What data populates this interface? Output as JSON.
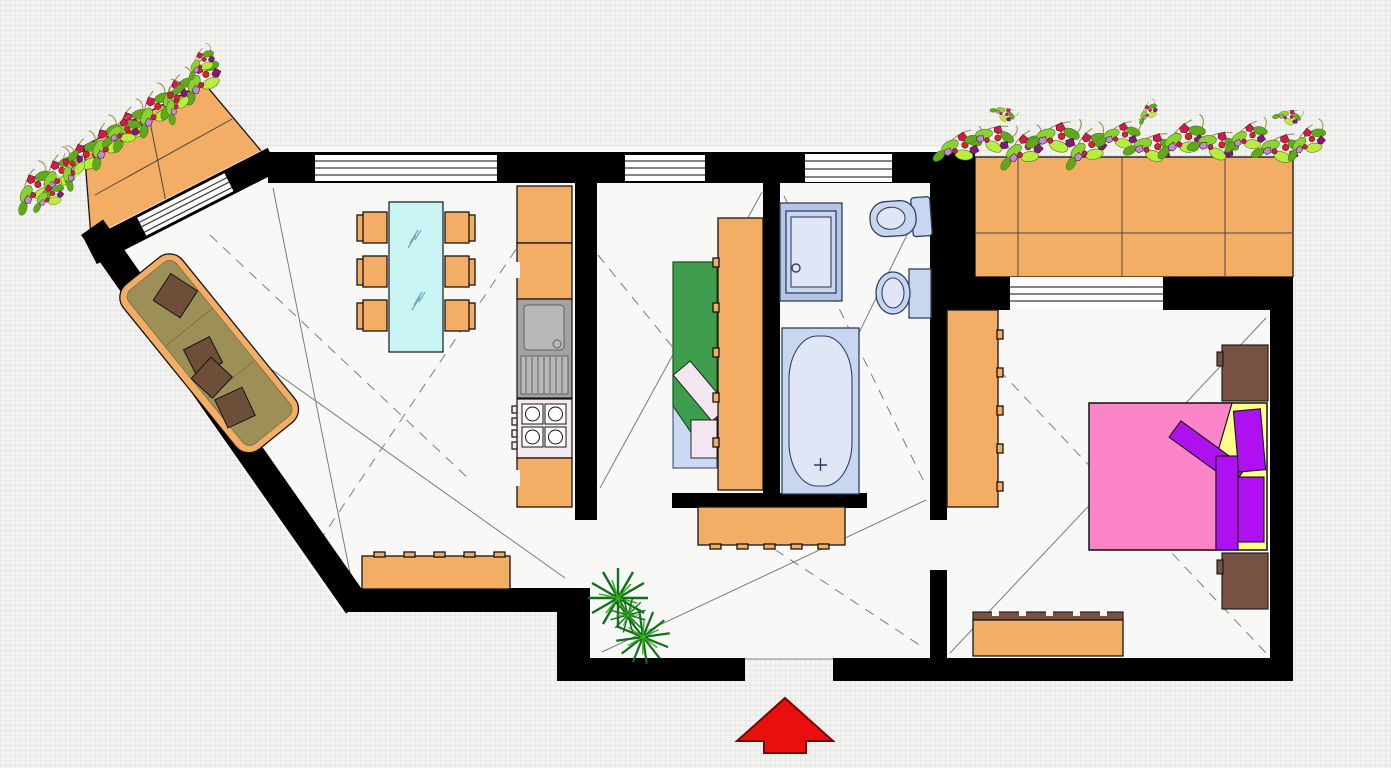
{
  "palette": {
    "wall": "#000000",
    "floor": "#f8f8f7",
    "grid_bg": "#f3f3f1",
    "grid_line": "#dedede",
    "window": "#ffffff",
    "window_line": "#3a3a3a",
    "tile": "#f4ad64",
    "tile_line": "#4a4a44",
    "outline": "#141414",
    "sofa_seat": "#9c8f57",
    "sofa_seam": "#837748",
    "sofa_pillow": "#6d4e38",
    "glass": "#c8f4f4",
    "glass_line": "#6fa3b5",
    "steel": "#a2a2a2",
    "steel_light": "#b8b8b8",
    "drain_line": "#606060",
    "stove": "#f6eaf1",
    "burner": "#ffffff",
    "fixture": "#c9d6f0",
    "fixture_light": "#dfe7f7",
    "fixture_line": "#2e3f63",
    "shower_frame": "#b7c5e4",
    "green_bed": "#3f9e4d",
    "green_dark": "#14541f",
    "sheet": "#ccd9f2",
    "pillow_pale": "#f4e6f0",
    "bed_pink": "#fb85c8",
    "bed_yellow": "#ffff8e",
    "bed_purple": "#af10f0",
    "wood_dark": "#775141",
    "arrow": "#ea0f0f",
    "arrow_outline": "#7c0000",
    "leaf1": "#8bd231",
    "leaf2": "#61a81c",
    "leaf3": "#b9ee3e",
    "leaf_line": "#3f7d12",
    "bloom1": "#d21a4a",
    "bloom2": "#7c1b7c",
    "bloom3": "#b78fdc",
    "bloom4": "#dd2222",
    "bloom_line": "#5c0e2e",
    "stem": "#a49146",
    "plant_dark": "#11701b",
    "plant_light": "#3cb31e",
    "line_thin": "#7c7c7c",
    "threshold": "#a8a8a8"
  },
  "plan": {
    "rooms": [
      {
        "name": "living-room-with-kitchen",
        "features": [
          "sofa",
          "dining-table",
          "chairs-6",
          "kitchen-cabinets",
          "kitchen-sink",
          "stove",
          "sideboard",
          "window",
          "balcony-door"
        ]
      },
      {
        "name": "middle-room",
        "features": [
          "single-bed",
          "wardrobe",
          "window"
        ]
      },
      {
        "name": "bathroom",
        "features": [
          "shower-cabin",
          "toilet",
          "washbasin",
          "bathtub",
          "window"
        ]
      },
      {
        "name": "bedroom",
        "features": [
          "double-bed",
          "wardrobe",
          "nightstand-top",
          "nightstand-bottom",
          "dresser",
          "window"
        ]
      },
      {
        "name": "hallway",
        "features": [
          "sideboard",
          "potted-plant",
          "entrance-opening"
        ]
      }
    ],
    "balconies": [
      {
        "name": "balcony-left",
        "features": [
          "tiled-floor",
          "flower-boxes"
        ]
      },
      {
        "name": "balcony-right",
        "features": [
          "tiled-floor",
          "flower-boxes"
        ]
      }
    ],
    "entrance_marker": "red-arrow"
  }
}
